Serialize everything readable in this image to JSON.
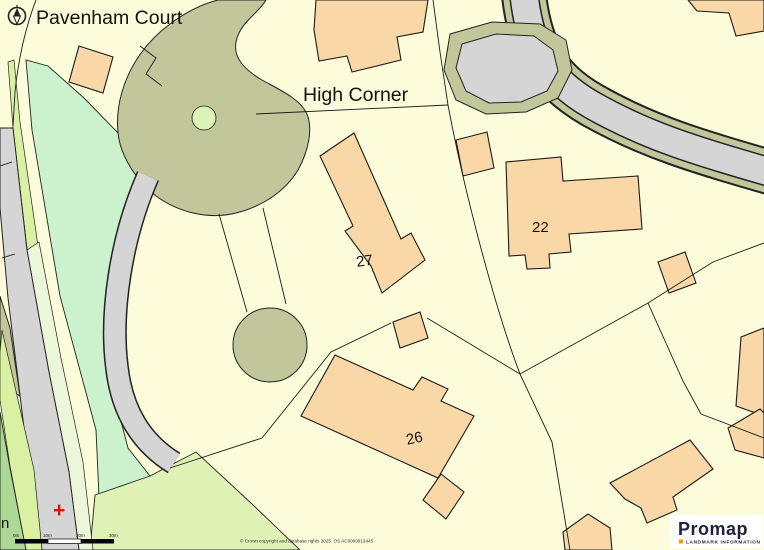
{
  "map": {
    "labels": {
      "pavenham_court": "Pavenham Court",
      "high_corner": "High Corner",
      "plot_27": "27",
      "plot_22": "22",
      "plot_26": "26",
      "street_partial": "n"
    },
    "marker": {
      "symbol": "+"
    },
    "scale_bar": {
      "ticks": [
        "0m",
        "10m",
        "20m",
        "30m"
      ]
    },
    "copyright": "© Crown copyright and database rights 2025. OS AC0000813445",
    "colors": {
      "background_cream": "#FCFCDA",
      "building_peach": "#F9D7A6",
      "olive_green": "#C2C79B",
      "mint_green": "#CBF2CD",
      "light_green": "#DFF2B5",
      "medium_green": "#ACD794",
      "road_gray": "#D5D5D5",
      "marker_red": "#FF0000",
      "logo_navy": "#22223F",
      "logo_orange": "#F59C00"
    }
  },
  "logo": {
    "name": "Promap",
    "tagline": "LANDMARK INFORMATION"
  }
}
